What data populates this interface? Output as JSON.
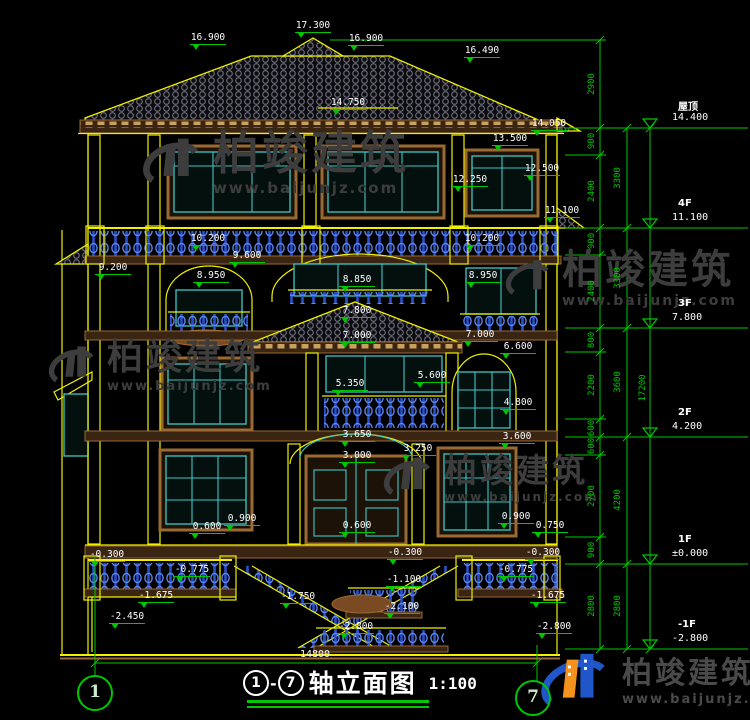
{
  "title": {
    "axis_left": "1",
    "axis_right": "7",
    "dash": "-",
    "name": "轴立面图",
    "scale": "1:100"
  },
  "watermark": {
    "brand": "柏竣建筑",
    "url": "www.baijunjz.com"
  },
  "bottom_dimension": {
    "value": "14800"
  },
  "axis_bubbles": [
    {
      "label": "1",
      "x": 95,
      "y": 693
    },
    {
      "label": "7",
      "x": 533,
      "y": 698
    }
  ],
  "floor_levels": [
    {
      "name": "屋顶",
      "value": "14.400",
      "y": 128
    },
    {
      "name": "4F",
      "value": "11.100",
      "y": 228
    },
    {
      "name": "3F",
      "value": "7.800",
      "y": 328
    },
    {
      "name": "2F",
      "value": "4.200",
      "y": 437
    },
    {
      "name": "1F",
      "value": "±0.000",
      "y": 564
    },
    {
      "name": "-1F",
      "value": "-2.800",
      "y": 649
    }
  ],
  "dim_chain_inner": [
    {
      "v": "2900",
      "x": 592,
      "y": 84
    },
    {
      "v": "900",
      "x": 592,
      "y": 141
    },
    {
      "v": "2400",
      "x": 592,
      "y": 191
    },
    {
      "v": "900",
      "x": 592,
      "y": 241
    },
    {
      "v": "2400",
      "x": 592,
      "y": 291
    },
    {
      "v": "800",
      "x": 592,
      "y": 340
    },
    {
      "v": "2200",
      "x": 592,
      "y": 385
    },
    {
      "v": "600",
      "x": 592,
      "y": 428
    },
    {
      "v": "600",
      "x": 592,
      "y": 446
    },
    {
      "v": "2700",
      "x": 592,
      "y": 496
    },
    {
      "v": "900",
      "x": 592,
      "y": 550
    },
    {
      "v": "2800",
      "x": 592,
      "y": 606
    }
  ],
  "dim_chain_middle": [
    {
      "v": "3300",
      "x": 618,
      "y": 178
    },
    {
      "v": "3300",
      "x": 618,
      "y": 278
    },
    {
      "v": "3600",
      "x": 618,
      "y": 382
    },
    {
      "v": "4200",
      "x": 618,
      "y": 500
    },
    {
      "v": "2800",
      "x": 618,
      "y": 606
    }
  ],
  "dim_chain_overall": [
    {
      "v": "17200",
      "x": 643,
      "y": 388
    }
  ],
  "elevation_annotations": [
    {
      "t": "16.900",
      "x": 208,
      "y": 33
    },
    {
      "t": "17.300",
      "x": 313,
      "y": 21
    },
    {
      "t": "16.900",
      "x": 366,
      "y": 34
    },
    {
      "t": "16.490",
      "x": 482,
      "y": 46
    },
    {
      "t": "14.750",
      "x": 348,
      "y": 98
    },
    {
      "t": "14.050",
      "x": 549,
      "y": 119
    },
    {
      "t": "13.500",
      "x": 510,
      "y": 134
    },
    {
      "t": "12.500",
      "x": 542,
      "y": 164
    },
    {
      "t": "12.250",
      "x": 470,
      "y": 175
    },
    {
      "t": "11.100",
      "x": 562,
      "y": 206
    },
    {
      "t": "10.200",
      "x": 208,
      "y": 234
    },
    {
      "t": "9.600",
      "x": 247,
      "y": 251
    },
    {
      "t": "9.200",
      "x": 113,
      "y": 263
    },
    {
      "t": "8.950",
      "x": 211,
      "y": 271
    },
    {
      "t": "10.200",
      "x": 482,
      "y": 234
    },
    {
      "t": "8.850",
      "x": 357,
      "y": 275
    },
    {
      "t": "8.950",
      "x": 483,
      "y": 271
    },
    {
      "t": "7.800",
      "x": 357,
      "y": 306
    },
    {
      "t": "7.000",
      "x": 357,
      "y": 331
    },
    {
      "t": "7.000",
      "x": 480,
      "y": 330
    },
    {
      "t": "6.600",
      "x": 518,
      "y": 342
    },
    {
      "t": "5.350",
      "x": 350,
      "y": 379
    },
    {
      "t": "5.600",
      "x": 432,
      "y": 371
    },
    {
      "t": "4.800",
      "x": 518,
      "y": 398
    },
    {
      "t": "3.600",
      "x": 517,
      "y": 432
    },
    {
      "t": "3.650",
      "x": 357,
      "y": 430
    },
    {
      "t": "3.250",
      "x": 418,
      "y": 444
    },
    {
      "t": "3.000",
      "x": 357,
      "y": 451
    },
    {
      "t": "0.900",
      "x": 242,
      "y": 514
    },
    {
      "t": "0.600",
      "x": 207,
      "y": 522
    },
    {
      "t": "0.600",
      "x": 357,
      "y": 521
    },
    {
      "t": "0.900",
      "x": 516,
      "y": 512
    },
    {
      "t": "0.750",
      "x": 550,
      "y": 521
    },
    {
      "t": "-0.300",
      "x": 107,
      "y": 550
    },
    {
      "t": "-0.775",
      "x": 192,
      "y": 565
    },
    {
      "t": "-1.675",
      "x": 156,
      "y": 591
    },
    {
      "t": "-2.450",
      "x": 127,
      "y": 612
    },
    {
      "t": "-1.750",
      "x": 298,
      "y": 592
    },
    {
      "t": "-0.300",
      "x": 405,
      "y": 548
    },
    {
      "t": "-1.100",
      "x": 404,
      "y": 575
    },
    {
      "t": "-2.100",
      "x": 402,
      "y": 602
    },
    {
      "t": "-2.800",
      "x": 356,
      "y": 622
    },
    {
      "t": "-0.300",
      "x": 543,
      "y": 548
    },
    {
      "t": "-0.775",
      "x": 516,
      "y": 565
    },
    {
      "t": "-1.675",
      "x": 548,
      "y": 591
    },
    {
      "t": "-2.800",
      "x": 554,
      "y": 622
    }
  ]
}
